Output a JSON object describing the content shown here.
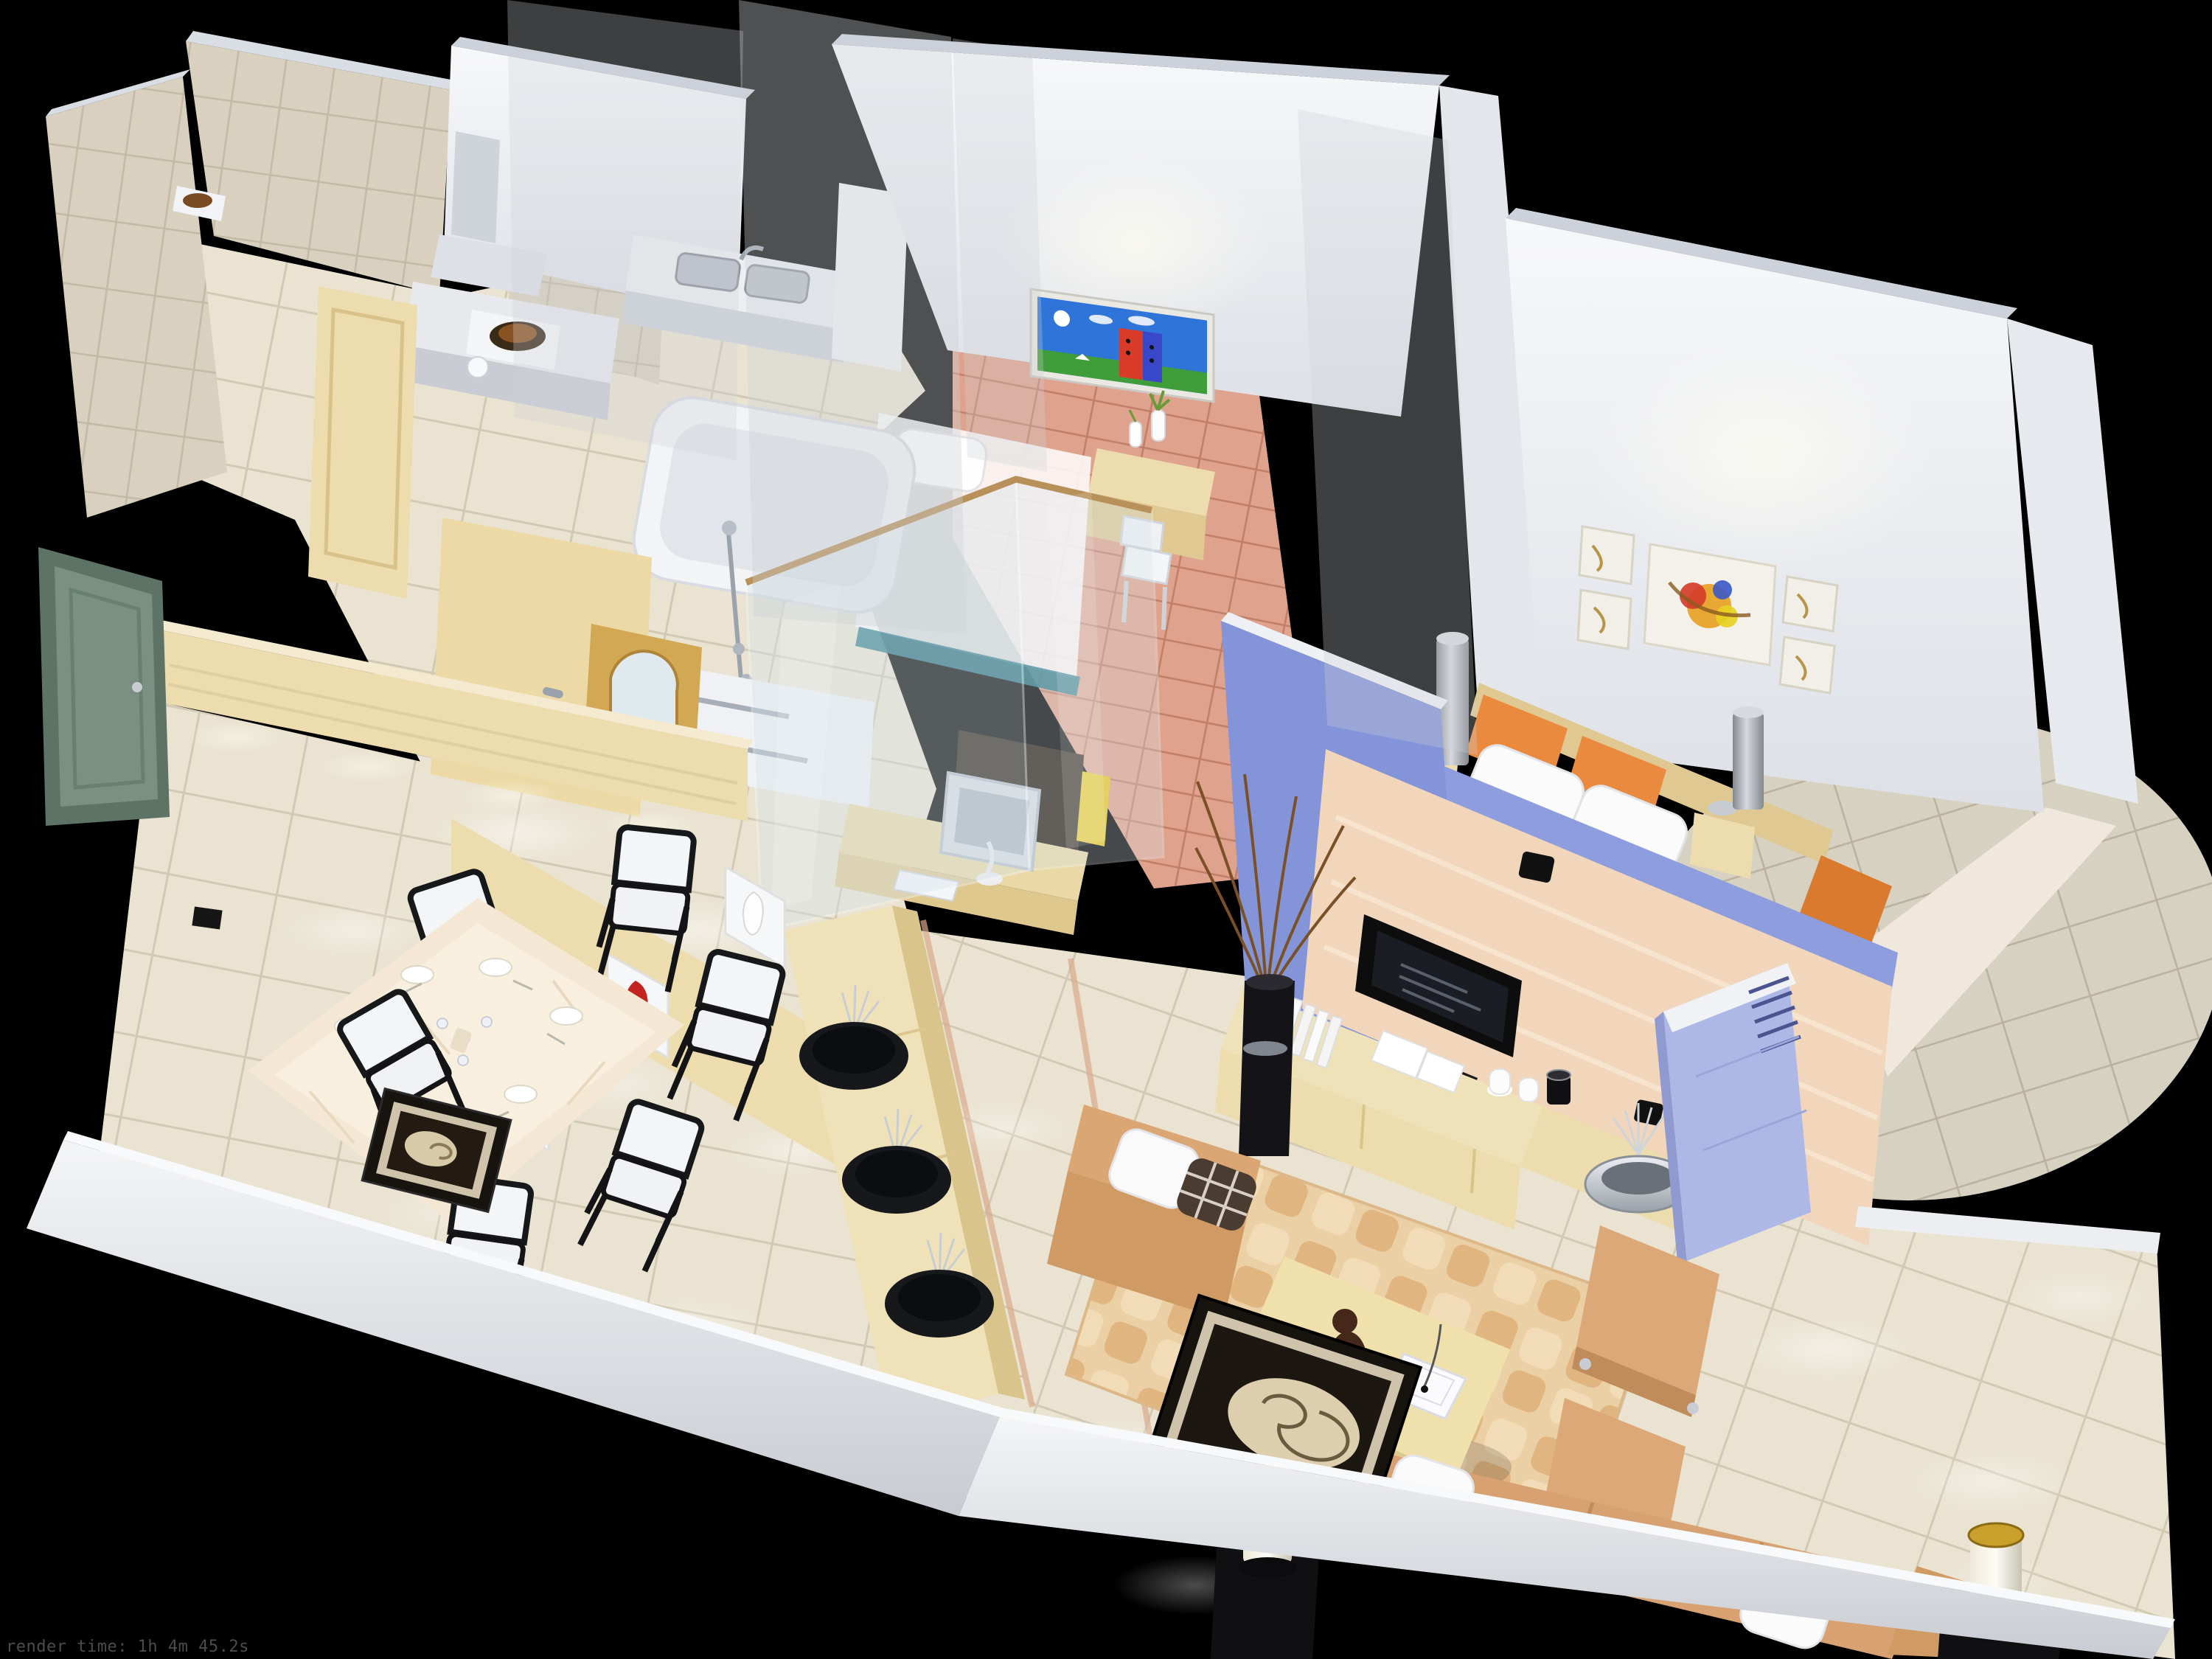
{
  "caption": {
    "render_time": "render time: 1h 4m 45.2s"
  },
  "colors": {
    "background": "#000000",
    "wall_top": "#ccd1da",
    "wall_white_hi": "#f6f7f9",
    "wall_white_lo": "#dde0e6",
    "kitchen_tile": "#d9d0bf",
    "kitchen_tile_grout": "#c3b9a5",
    "floor_beige": "#eae3d1",
    "floor_beige_grout": "#d2c9b3",
    "floor_pink": "#dfa28c",
    "floor_pink_grout": "#c17e66",
    "terrace_tile": "#d7d1c1",
    "terrace_grout": "#b9b19d",
    "door_green": "#7b9082",
    "door_green_frame": "#5d7366",
    "wood_light": "#ecdcae",
    "wood_mid": "#dfc892",
    "blue_wall": "#8494d8",
    "blue_wall_light": "#8e9ddd",
    "peach_wall": "#f1d6bb",
    "ac_blue": "#aeb8e6",
    "rug_base": "#ecd0a5",
    "rug_weave": "#dfb079",
    "sofa_tan": "#d7a171",
    "ottoman_tan": "#dca878",
    "table_wood": "#f0e0ac",
    "console_wood": "#f0e2b8",
    "tv_black": "#0d0d0d",
    "frame_black": "#17130e",
    "mat_cream": "#cfc3ab",
    "shell_cream": "#ddcfae",
    "orange_bed": "#e98a3e",
    "lamp_gold": "#c9a02c",
    "lamp_white": "#f6f2e4",
    "glass_tint": "#d7e4ea",
    "chrome": "#9aa2ac",
    "twig_brown": "#7a5026",
    "vase_red": "#c42420",
    "caption_gray": "#4c4c4c"
  }
}
